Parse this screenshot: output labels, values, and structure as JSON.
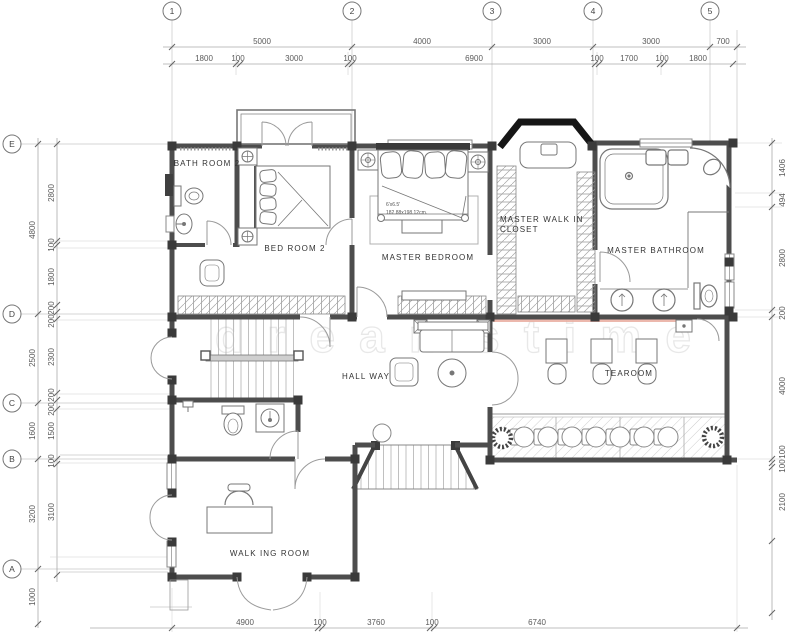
{
  "drawing": {
    "grid": {
      "columns": [
        "1",
        "2",
        "3",
        "4",
        "5"
      ],
      "rows": [
        "E",
        "D",
        "C",
        "B",
        "A"
      ]
    },
    "dimensions": {
      "top_row1": [
        "5000",
        "4000",
        "3000",
        "3000",
        "700"
      ],
      "top_row2": [
        "1800",
        "100",
        "3000",
        "100",
        "6900",
        "100",
        "1700",
        "100",
        "1800"
      ],
      "left_outer": [
        "4800",
        "2500",
        "1600",
        "3200",
        "1000"
      ],
      "left_inner": [
        "2800",
        "100",
        "1800",
        "200",
        "200",
        "2300",
        "200",
        "200",
        "1500",
        "100",
        "3100"
      ],
      "right": [
        "1406",
        "494",
        "2800",
        "200",
        "4000",
        "100",
        "100",
        "2100"
      ],
      "bottom": [
        "4900",
        "100",
        "3760",
        "100",
        "6740"
      ]
    },
    "rooms": [
      {
        "id": "bath-room-2",
        "label": "BATH ROOM 2"
      },
      {
        "id": "bed-room-2",
        "label": "BED ROOM 2"
      },
      {
        "id": "master-bedroom",
        "label": "MASTER BEDROOM"
      },
      {
        "id": "master-walk-in-closet-line1",
        "label": "MASTER WALK IN"
      },
      {
        "id": "master-walk-in-closet-line2",
        "label": "CLOSET"
      },
      {
        "id": "master-bathroom",
        "label": "MASTER BATHROOM"
      },
      {
        "id": "hall-way",
        "label": "HALL WAY"
      },
      {
        "id": "tearoom",
        "label": "TEAROOM"
      },
      {
        "id": "walking-room",
        "label": "WALK ING ROOM"
      }
    ],
    "annotations": {
      "bed_size_ft": "6'x6.5'",
      "bed_size_cm": "182.88x198.12cm."
    },
    "watermark": "dreamstime",
    "colors": {
      "wall": "#4d4d4d",
      "black_wall": "#161616",
      "line": "#9a9a9a",
      "dim_text": "#5a5a5a",
      "accent_red": "#e9ab9f"
    }
  }
}
